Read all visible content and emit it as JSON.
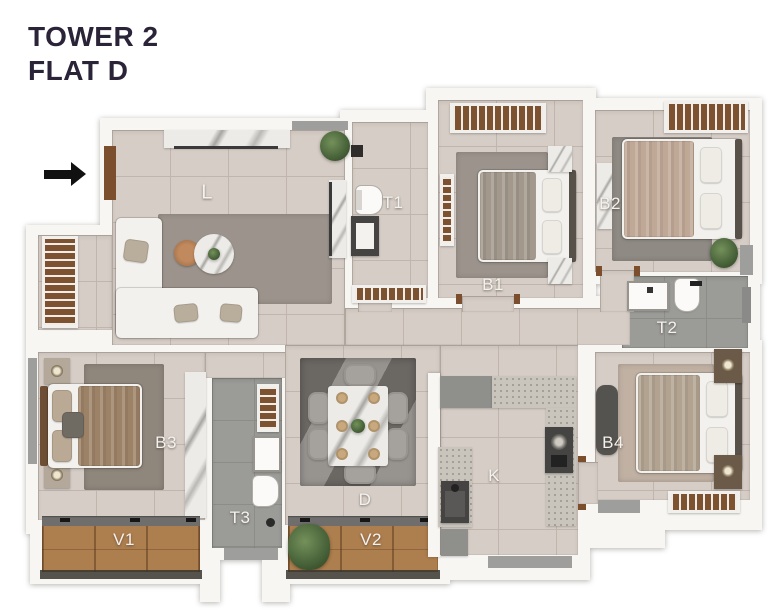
{
  "title": {
    "line1": "TOWER 2",
    "line2": "FLAT D"
  },
  "entrance": {
    "arrow_direction": "right"
  },
  "rooms": {
    "living": {
      "label": "L"
    },
    "toilet1": {
      "label": "T1"
    },
    "bedroom1": {
      "label": "B1"
    },
    "bedroom2": {
      "label": "B2"
    },
    "toilet2": {
      "label": "T2"
    },
    "bedroom3": {
      "label": "B3"
    },
    "veranda1": {
      "label": "V1"
    },
    "toilet3": {
      "label": "T3"
    },
    "dining": {
      "label": "D"
    },
    "veranda2": {
      "label": "V2"
    },
    "kitchen": {
      "label": "K"
    },
    "bedroom4": {
      "label": "B4"
    }
  },
  "colors": {
    "title-text": "#2b2438",
    "room-label": "#f4f2ef",
    "wall": "#f7f6f3",
    "floor-tile": "#d6cdc6",
    "floor-grout": "#c0b6ae",
    "toilet-floor": "#9b9b98",
    "toilet-grout": "#8c8c89",
    "wood": "#ad7e4e",
    "louver-wood": "#7d5231",
    "granite": "#c9c5bc",
    "marble": "#edebe7",
    "appliance-grey": "#8f8f8c",
    "appliance-dark": "#454442",
    "rug-grey": "#9c948c",
    "rug-dark": "#6e6a66",
    "bed-linen": "#f3f1ed",
    "headboard": "#57514a",
    "plant-green": "#49633a",
    "window-grey": "#9e9e9c",
    "shadow-band": "#39362f",
    "door-wood": "#7b4f2e",
    "arrow-black": "#111111"
  }
}
